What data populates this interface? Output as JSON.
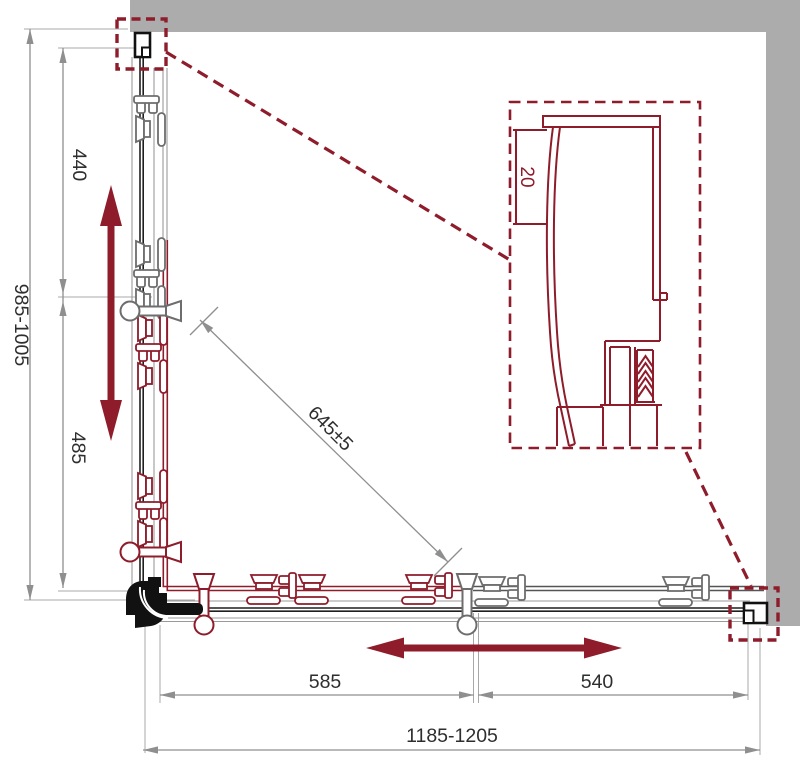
{
  "diagram": {
    "title": "corner-shower-enclosure-installation-plan",
    "colors": {
      "wall_gray": "#ACACAC",
      "accent_red": "#8E1C2B",
      "drawing_black": "#1F1F1F",
      "dimension_gray": "#8F8F8F",
      "text_dark": "#2E2E2E"
    },
    "dimensions": {
      "depth_overall": "985-1005",
      "depth_upper": "440",
      "depth_lower": "485",
      "diagonal_opening": "645±5",
      "width_left_door": "585",
      "width_right_door": "540",
      "width_overall": "1185-1205",
      "detail_offset": "20"
    }
  }
}
